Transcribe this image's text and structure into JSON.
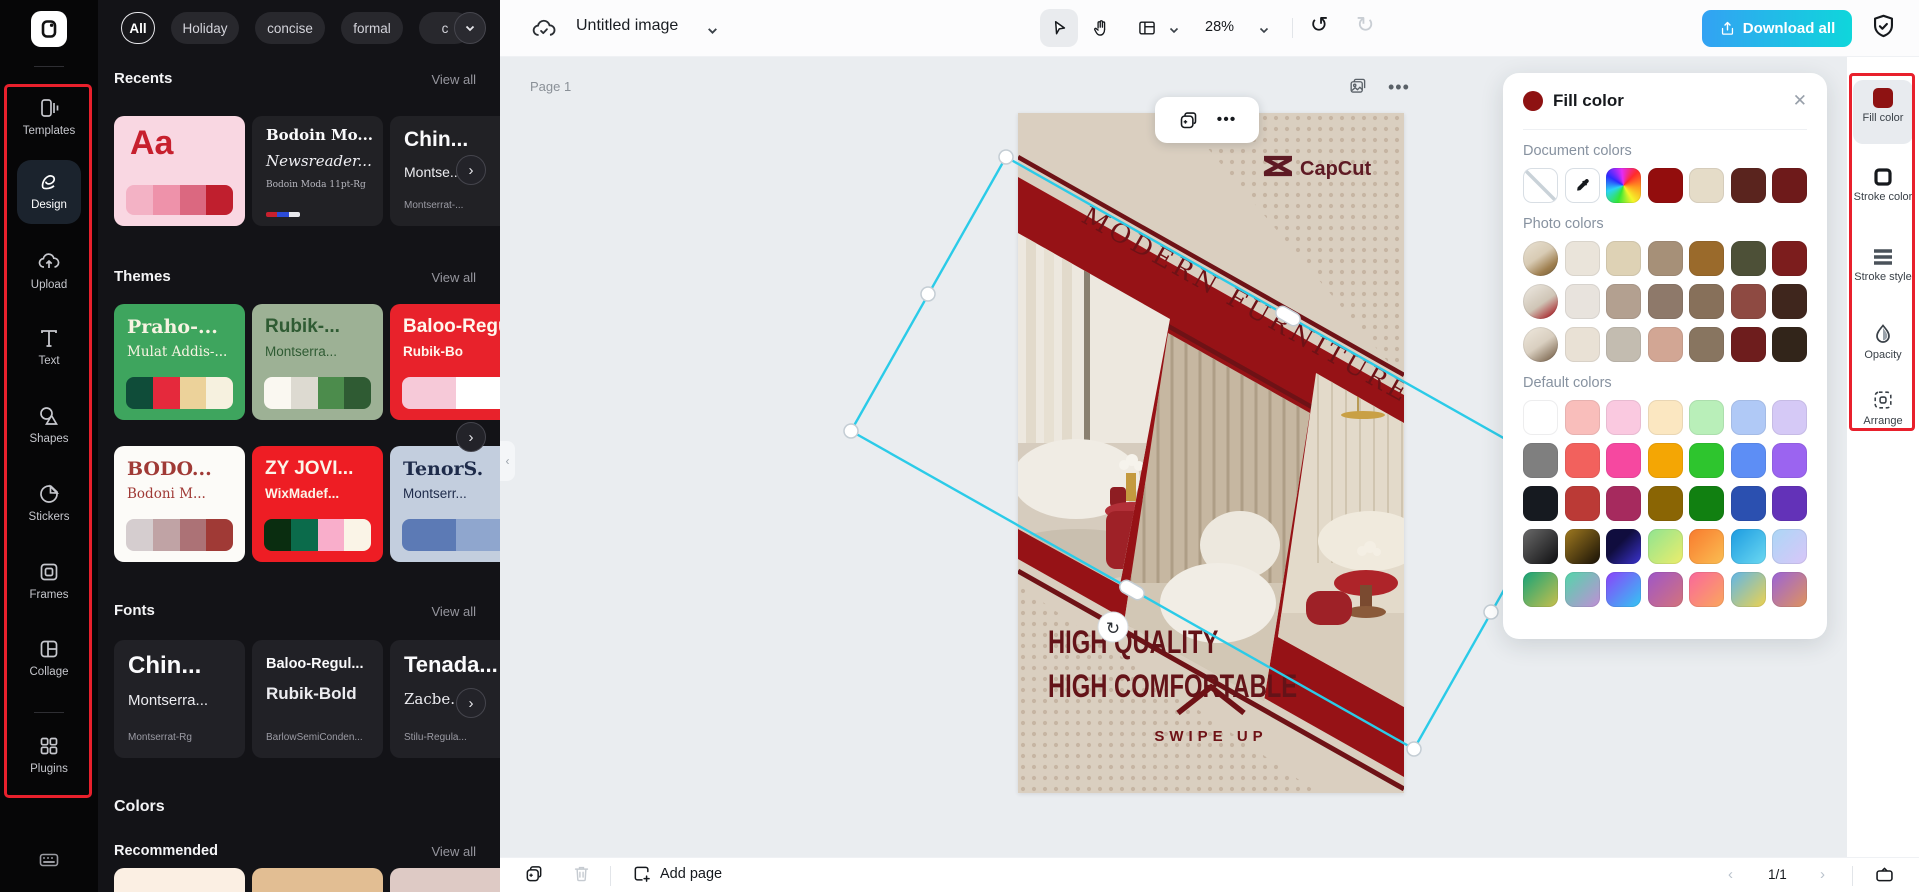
{
  "annotation_color": "#E8202C",
  "left_rail": {
    "items": [
      {
        "label": "Templates"
      },
      {
        "label": "Design"
      },
      {
        "label": "Upload"
      },
      {
        "label": "Text"
      },
      {
        "label": "Shapes"
      },
      {
        "label": "Stickers"
      },
      {
        "label": "Frames"
      },
      {
        "label": "Collage"
      },
      {
        "label": "Plugins"
      }
    ]
  },
  "templates_panel": {
    "filters": [
      "All",
      "Holiday",
      "concise",
      "formal",
      "c"
    ],
    "sections": {
      "recents": "Recents",
      "themes": "Themes",
      "fonts": "Fonts",
      "colors": "Colors",
      "recommended": "Recommended",
      "view_all": "View all"
    },
    "recents": {
      "c1": {
        "bg": "#F9D7E2",
        "title": "Aa",
        "title_color": "#C7202E",
        "palette": [
          "#F3B2C5",
          "#EE92AA",
          "#DB6880",
          "#C01F2E"
        ]
      },
      "c2": {
        "bg": "#212125",
        "line1": "Bodoin Mo...",
        "line2": "Newsreader...",
        "line3": "Bodoin Moda 11pt-Rg",
        "strip": [
          "#C7202E",
          "#2B4BD8",
          "#E8E8EC"
        ]
      },
      "c3": {
        "bg": "#212125",
        "line1": "Chin...",
        "line2": "Montse...",
        "line3": "Montserrat-..."
      }
    },
    "themes": [
      {
        "title": "Praho-...",
        "sub": "Mulat Addis-...",
        "bg": "#3EA55E",
        "fg": "#F7F3E2",
        "palette": [
          "#0F4C39",
          "#E5293C",
          "#ECD29A",
          "#F6F1DF"
        ]
      },
      {
        "title": "Rubik-...",
        "sub": "Montserra...",
        "bg": "#9DB195",
        "fg": "#2F5B33",
        "palette": [
          "#FAF8F1",
          "#DDDAD1",
          "#4C8C4C",
          "#2F5B33"
        ]
      },
      {
        "title": "Baloo-Regu",
        "sub": "Rubik-Bo",
        "bg": "#E8222B",
        "fg": "#FFF6EC",
        "palette": [
          "#F6C9D8",
          "#FFFFFF"
        ]
      },
      {
        "title": "BODO...",
        "sub": "Bodoni M...",
        "bg": "#FCFBF8",
        "fg": "#A03A36",
        "palette": [
          "#D5CDCF",
          "#C0A3A5",
          "#AC7276",
          "#A03A36"
        ]
      },
      {
        "title": "ZY JOVI...",
        "sub": "WixMadef...",
        "bg": "#EE1D24",
        "fg": "#FBF5E9",
        "palette": [
          "#0A2D10",
          "#0B6B4B",
          "#F9AECB",
          "#FAF4E7"
        ]
      },
      {
        "title": "TenorS.",
        "sub": "Montserr...",
        "bg": "#C3CEDE",
        "fg": "#1E2B4A",
        "palette": [
          "#5C7AB5",
          "#8FA6CE"
        ]
      }
    ],
    "fonts": [
      {
        "title": "Chin...",
        "sub": "Montserra...",
        "small": "Montserrat-Rg"
      },
      {
        "title": "Baloo-Regul...",
        "sub": "Rubik-Bold",
        "small": "BarlowSemiConden..."
      },
      {
        "title": "Tenada...",
        "sub": "Zacbe...",
        "small": "Stilu-Regula..."
      }
    ],
    "color_cards": [
      "#FBEFE3",
      "#E2BE93",
      "#DECAC5"
    ]
  },
  "topbar": {
    "title": "Untitled image",
    "zoom": "28%",
    "download": "Download all"
  },
  "canvas": {
    "page_label": "Page 1",
    "add_page": "Add page",
    "page_indicator": "1/1"
  },
  "poster": {
    "brand": "CapCut",
    "headline": "MODERN FURNITURE",
    "sub1": "HIGH QUALITY",
    "sub2": "HIGH COMFORTABLE",
    "cta": "SWIPE UP",
    "colors": {
      "bg": "#DACFC0",
      "band": "#961216",
      "dark": "#6E1216",
      "selection": "#2BCBE8"
    }
  },
  "fill_panel": {
    "title": "Fill color",
    "selected_color": "#8E1212",
    "sections": {
      "document": "Document colors",
      "photo": "Photo colors",
      "default": "Default colors"
    },
    "rainbow": "conic-gradient(from 45deg,#FF2B2B,#FF9A1F,#F5F52A,#35E635,#2AD4F5,#2B2BFF,#E42BF5,#FF2B2B)",
    "document_colors": [
      "#930D0D",
      "#E5DCC8",
      "#5A241E",
      "#6E1A1A"
    ],
    "photo_rows": [
      {
        "thumb": "linear-gradient(145deg,#E9E2D4 0%,#D8CBB4 45%,#9E7E4E 75%,#6E5A38 100%)",
        "colors": [
          "#EAE4DA",
          "#DED2B5",
          "#A69078",
          "#9A6A2B",
          "#4D5037",
          "#7C1D1D"
        ]
      },
      {
        "thumb": "linear-gradient(145deg,#EFEBE4 0%,#CFC5B6 55%,#A8242A 90%)",
        "colors": [
          "#E8E3DD",
          "#B3A090",
          "#8E796A",
          "#87705A",
          "#8E4A42",
          "#3F261D"
        ]
      },
      {
        "thumb": "linear-gradient(145deg,#EFE9DE 0%,#D9CFC0 50%,#8A7660 85%,#5E4E3E 100%)",
        "colors": [
          "#E9E1D5",
          "#C3BCB0",
          "#D2A694",
          "#887560",
          "#6E1D1D",
          "#32251A"
        ]
      }
    ],
    "default_rows": [
      [
        "#FFFFFF",
        "#F9BEBB",
        "#FAC9E0",
        "#FBE7C1",
        "#B9EFB9",
        "#B0C9F6",
        "#D5C9F6"
      ],
      [
        "#7F7F7F",
        "#F2615D",
        "#F648A0",
        "#F4A604",
        "#2EC52E",
        "#5D8EF5",
        "#9B64F0"
      ],
      [
        "#161A20",
        "#BB3A36",
        "#A62A5E",
        "#8A6504",
        "#118011",
        "#2B50B0",
        "#6332B8"
      ],
      [
        "linear-gradient(135deg,#6A6A6A,#0E0E10)",
        "linear-gradient(135deg,#A07A20,#171006)",
        "linear-gradient(135deg,#100D3E 40%,#3B33D0)",
        "linear-gradient(135deg,#8FE491,#EDED6B)",
        "linear-gradient(135deg,#F87A2E,#FBBE52)",
        "linear-gradient(135deg,#1C9BE0,#6CD9F2)",
        "linear-gradient(135deg,#ABD7F6,#D9C6F8)"
      ],
      [
        "linear-gradient(135deg,#16A378,#C8BF4C)",
        "linear-gradient(135deg,#52D6A9,#C08ED6)",
        "linear-gradient(135deg,#8B42FA,#33C6F3)",
        "linear-gradient(135deg,#9E56C8,#D4737B)",
        "linear-gradient(135deg,#F9679C,#FBA75C)",
        "linear-gradient(135deg,#5FB6E8,#EDD24F)",
        "linear-gradient(135deg,#9A63D8,#E0935C)"
      ]
    ]
  },
  "right_rail": {
    "items": [
      {
        "label": "Fill color"
      },
      {
        "label": "Stroke color"
      },
      {
        "label": "Stroke style"
      },
      {
        "label": "Opacity"
      },
      {
        "label": "Arrange"
      }
    ]
  }
}
